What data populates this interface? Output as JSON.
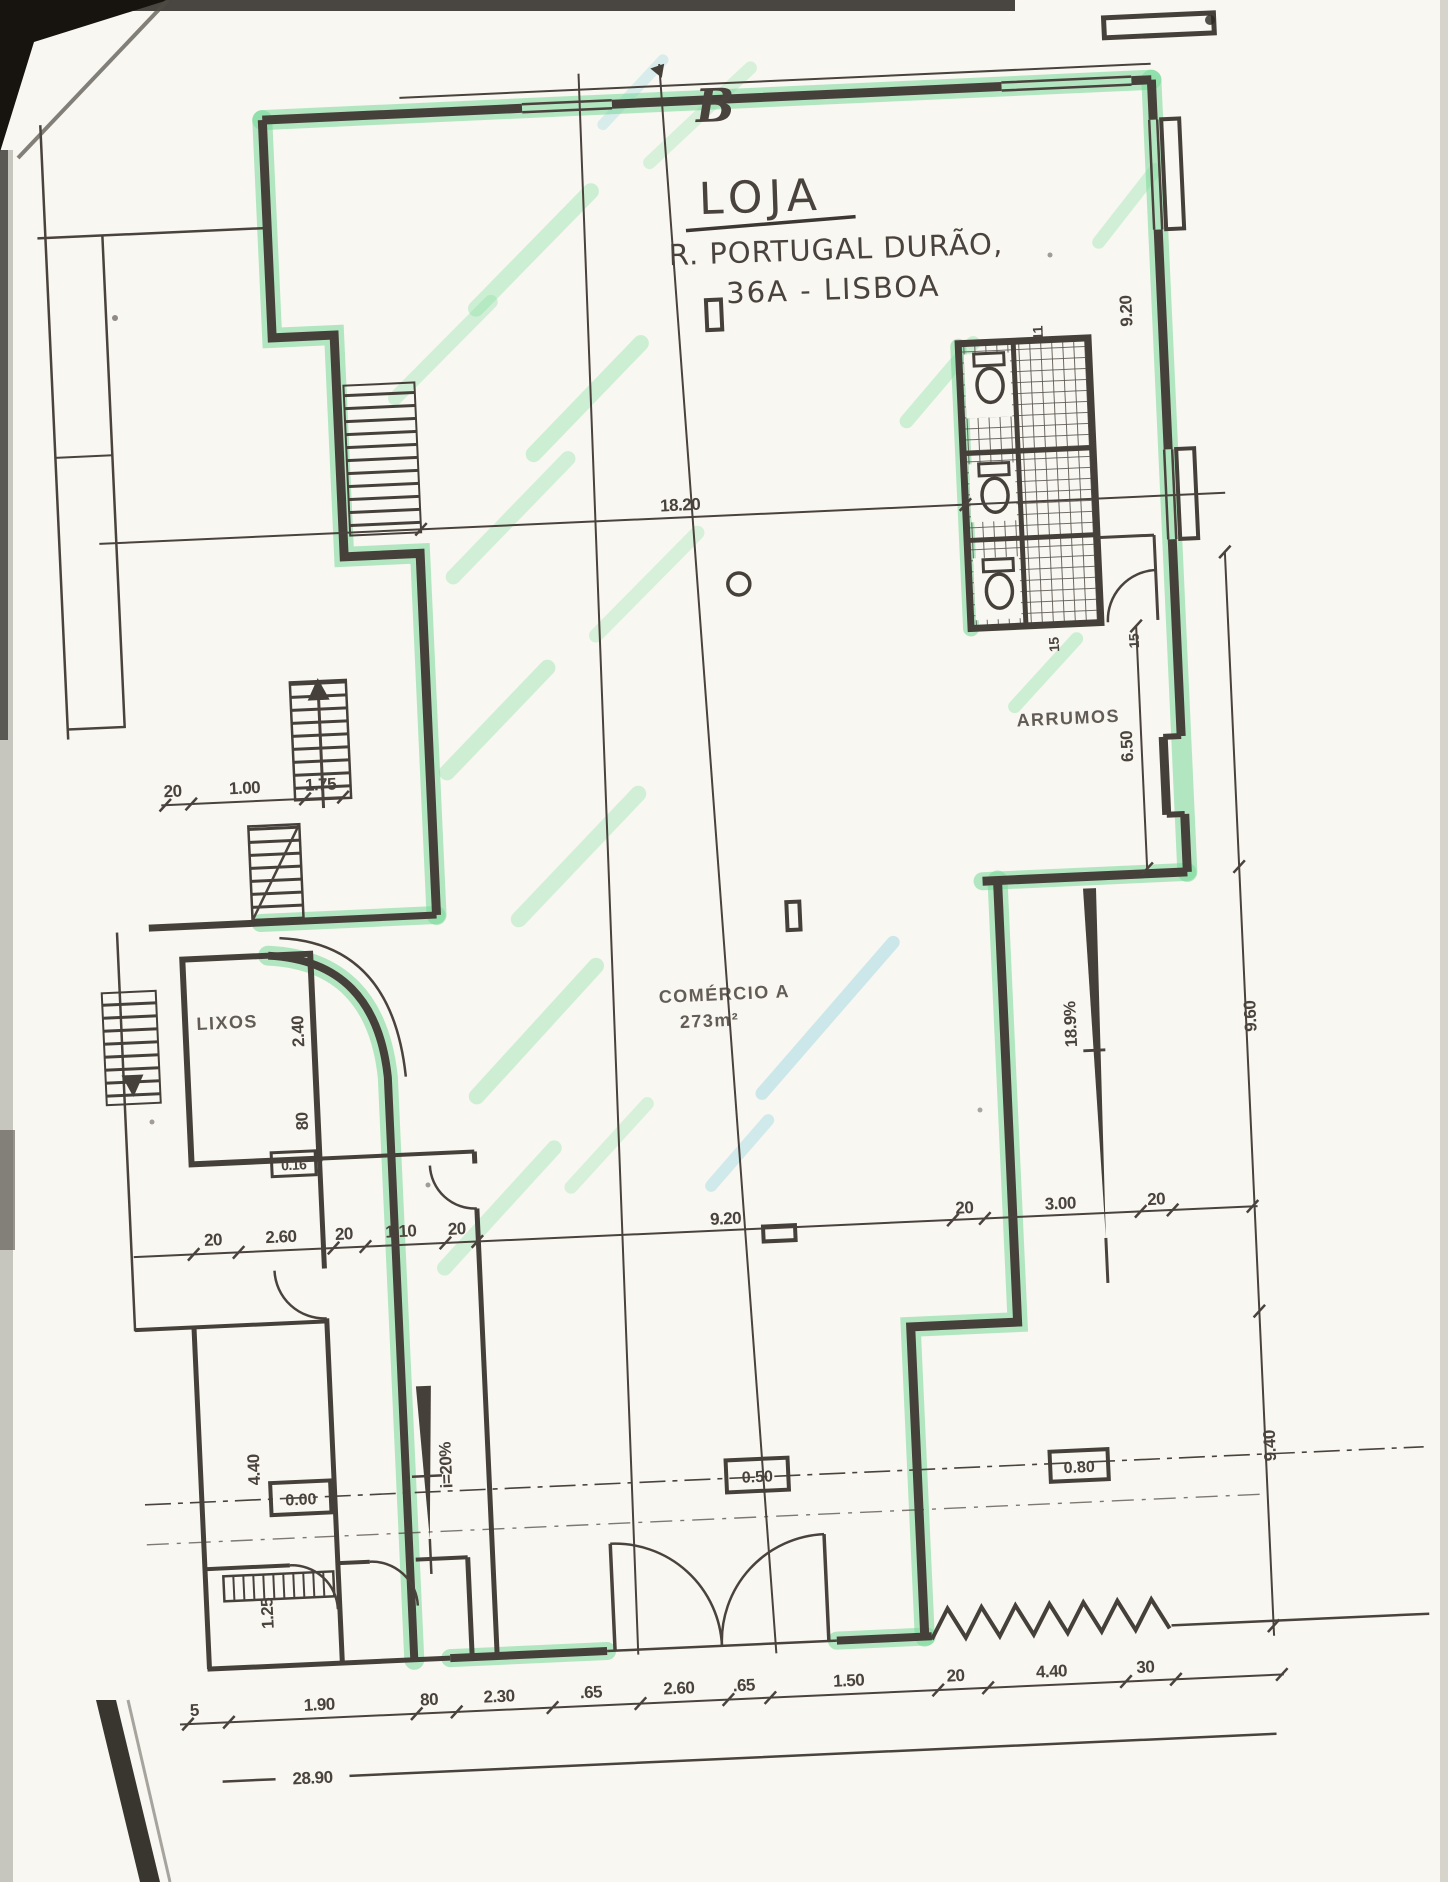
{
  "plan": {
    "handwritten": {
      "section_letter": "B",
      "title": "LOJA",
      "address_line1": "R. PORTUGAL DURÃO,",
      "address_line2": "36A - LISBOA"
    },
    "rooms": {
      "comercio": "COMÉRCIO A",
      "comercio_area": "273m²",
      "arrumos": "ARRUMOS",
      "lixos": "LIXOS"
    },
    "levels": {
      "zero": "0.00",
      "mid": "0.50",
      "right": "0.80",
      "small": "0.16"
    },
    "slopes": {
      "right_ramp": "18.9%",
      "left_ramp": "i=20%"
    },
    "dims": {
      "top": "18.20",
      "upper_left": [
        "20",
        "1.00",
        "1.75"
      ],
      "middle": [
        "20",
        "2.60",
        "20",
        "1.10",
        "20",
        "9.20",
        "20",
        "3.00",
        "20"
      ],
      "bottom": [
        "5",
        "1.90",
        "80",
        "2.30",
        ".65",
        "2.60",
        ".65",
        "1.50",
        "20",
        "4.40",
        "30"
      ],
      "total": "28.90",
      "right": [
        "9.20",
        "6.50",
        "9.60",
        "9.40"
      ],
      "left": [
        "2.40",
        "80",
        "4.40",
        "1.25"
      ],
      "wc": [
        "11",
        "15",
        "15"
      ]
    },
    "colors": {
      "ink": "#46403a",
      "highlighter_green": "#77d898",
      "highlighter_cyan": "#9fd8e2",
      "paper": "#f8f7f1"
    }
  }
}
